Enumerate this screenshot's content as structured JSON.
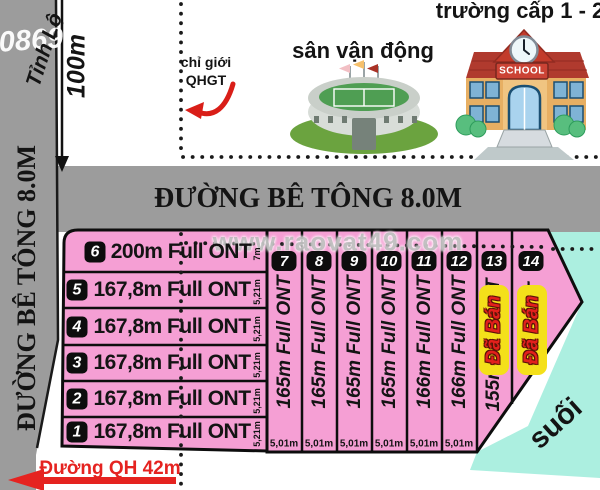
{
  "watermark": {
    "site": "www.raovat49.com",
    "phone": "0869"
  },
  "landmarks": {
    "school_title": "trường cấp 1 - 2",
    "school_sign": "SCHOOL",
    "stadium_title": "sân vận động",
    "boundary_line1": "chỉ giới",
    "boundary_line2": "QHGT",
    "stream": "suối"
  },
  "roads": {
    "concrete_top": "ĐƯỜNG BÊ TÔNG 8.0M",
    "concrete_left": "ĐƯỜNG BÊ TÔNG 8.0M",
    "provincial": "Tỉnh Lộ",
    "planned_bottom": "Đường QH 42m",
    "distance_marker": "100m"
  },
  "sold_label": "Đã Bán",
  "plots_left": [
    {
      "no": "6",
      "label": "200m Full ONT",
      "width": "7m"
    },
    {
      "no": "5",
      "label": "167,8m Full ONT",
      "width": "5,21m"
    },
    {
      "no": "4",
      "label": "167,8m Full ONT",
      "width": "5,21m"
    },
    {
      "no": "3",
      "label": "167,8m Full ONT",
      "width": "5,21m"
    },
    {
      "no": "2",
      "label": "167,8m Full ONT",
      "width": "5,21m"
    },
    {
      "no": "1",
      "label": "167,8m Full ONT",
      "width": "5,21m"
    }
  ],
  "plots_strips": [
    {
      "no": "7",
      "label": "165m Full ONT",
      "width": "5,01m",
      "sold": false
    },
    {
      "no": "8",
      "label": "165m Full ONT",
      "width": "5,01m",
      "sold": false
    },
    {
      "no": "9",
      "label": "165m Full ONT",
      "width": "5,01m",
      "sold": false
    },
    {
      "no": "10",
      "label": "165m Full ONT",
      "width": "5,01m",
      "sold": false
    },
    {
      "no": "11",
      "label": "166m Full ONT",
      "width": "5,01m",
      "sold": false
    },
    {
      "no": "12",
      "label": "166m Full ONT",
      "width": "5,01m",
      "sold": false
    },
    {
      "no": "13",
      "label": "155m Full ONT",
      "width": "",
      "sold": true
    },
    {
      "no": "14",
      "label": "Full ONT",
      "width": "",
      "sold": true
    }
  ],
  "colors": {
    "plot_pink": "#F59FD4",
    "road_gray": "#9C9C9C",
    "stream_teal": "#ACEFE0",
    "sold_yellow": "#F4E01A",
    "accent_red": "#E52320"
  }
}
